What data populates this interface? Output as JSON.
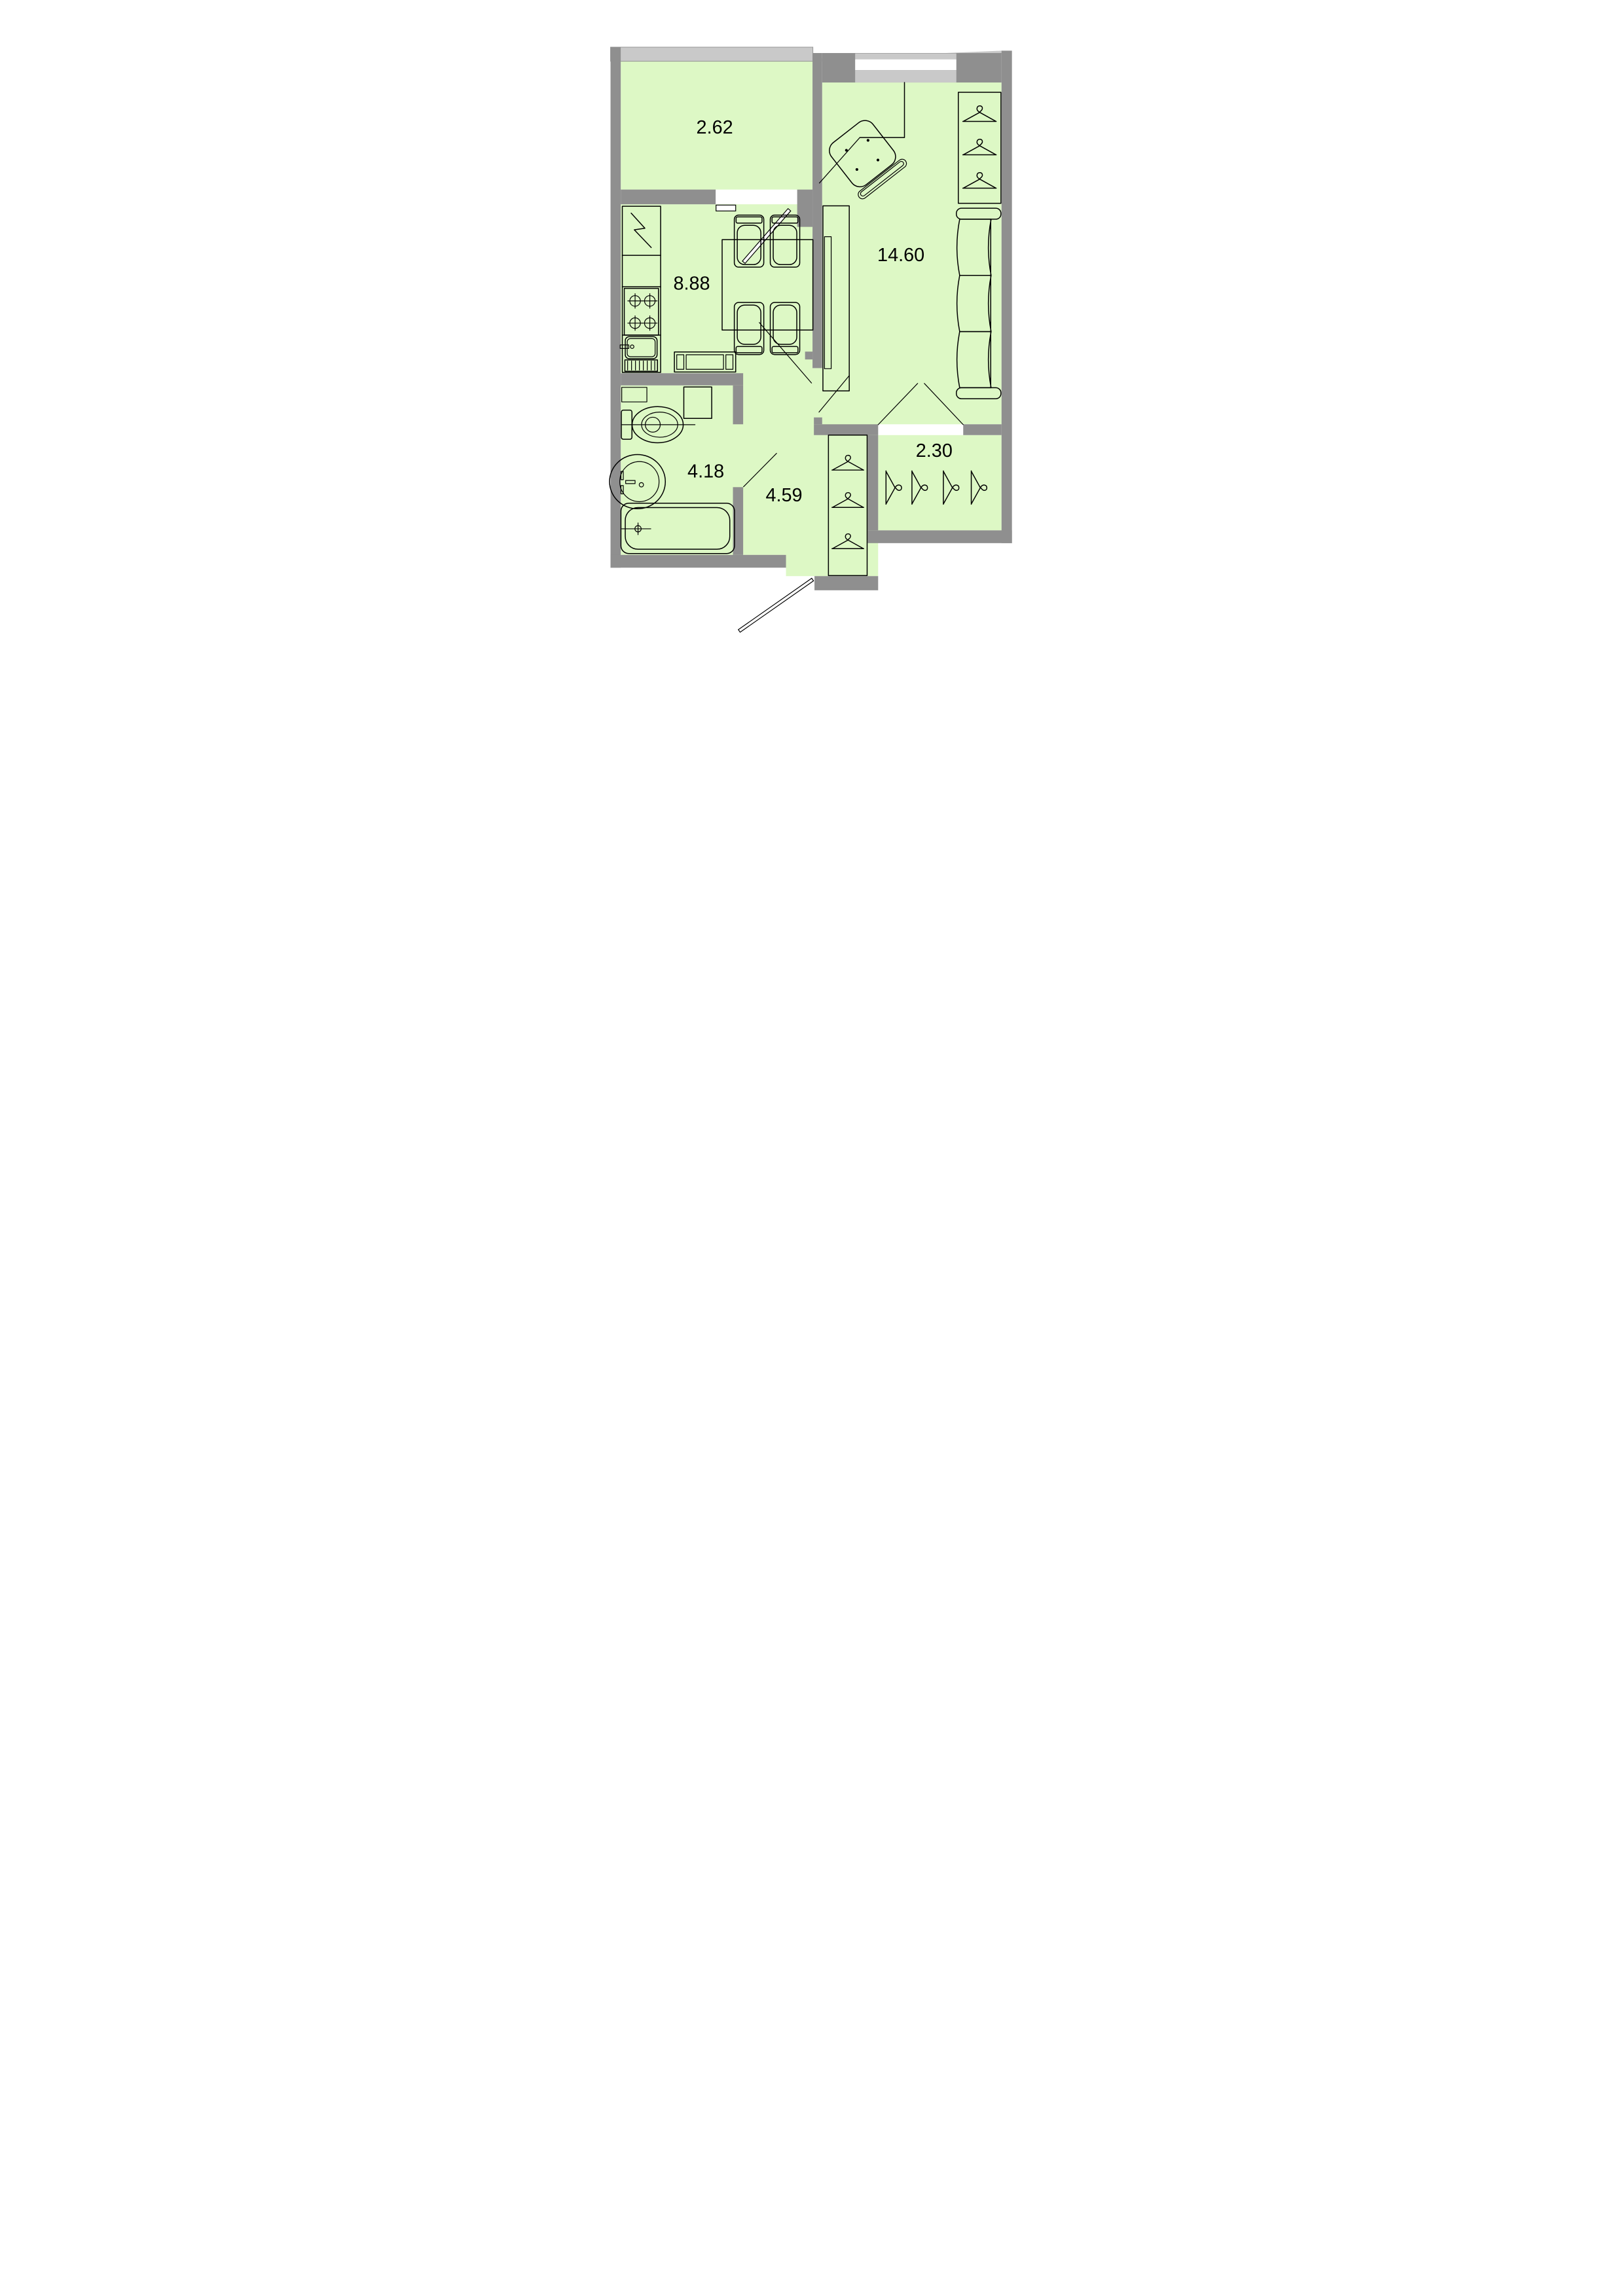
{
  "document": {
    "type": "apartment-floor-plan"
  },
  "colors": {
    "room_fill": "#ddf8c5",
    "wall": "#8f8f8f",
    "balcony_rail": "#c9c9c9",
    "window_glass": "#ffffff",
    "line": "#000000"
  },
  "rooms": [
    {
      "name": "balcony",
      "area_label": "2.62"
    },
    {
      "name": "kitchen",
      "area_label": "8.88"
    },
    {
      "name": "living-room",
      "area_label": "14.60"
    },
    {
      "name": "bathroom",
      "area_label": "4.18"
    },
    {
      "name": "hallway",
      "area_label": "4.59"
    },
    {
      "name": "closet",
      "area_label": "2.30"
    }
  ],
  "symbols": [
    "fridge-icon",
    "stove-icon",
    "kitchen-sink-icon",
    "dining-table-icon",
    "chair-icon",
    "balcony-door-icon",
    "balcony-window-icon",
    "window-icon",
    "desk-icon",
    "office-chair-icon",
    "wardrobe-icon",
    "coat-hanger-icon",
    "sofa-icon",
    "tv-stand-icon",
    "washing-machine-icon",
    "shelf-icon",
    "toilet-icon",
    "washbasin-icon",
    "bathtub-icon",
    "door-swing-icon",
    "entrance-door-icon"
  ]
}
